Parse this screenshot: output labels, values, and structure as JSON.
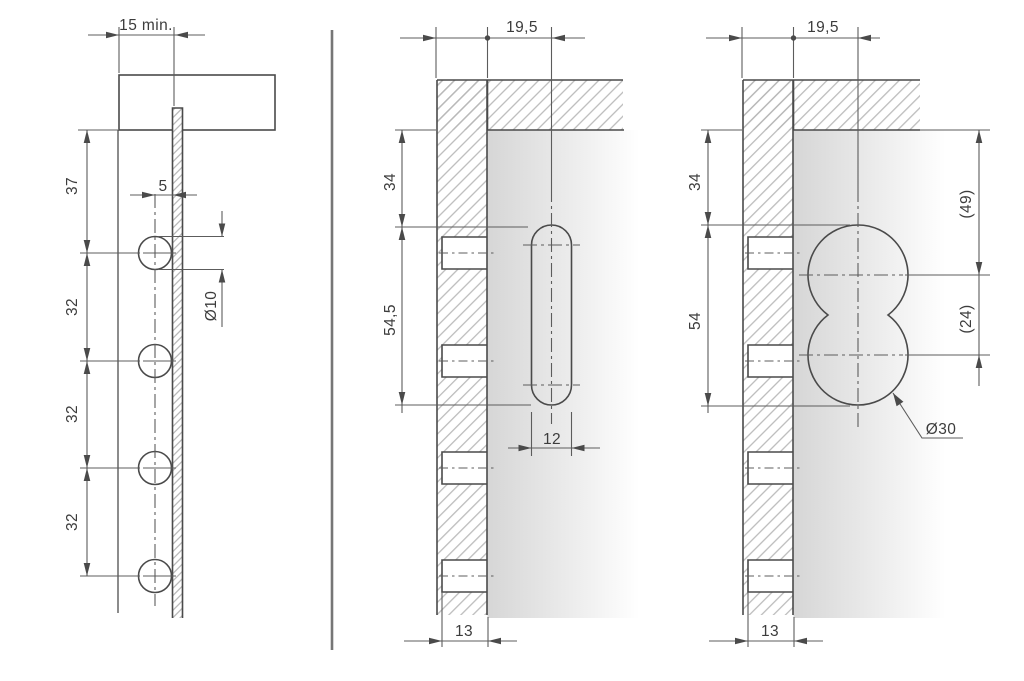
{
  "drawing": {
    "type": "furniture hinge mounting plate drilling diagram, three sectional views",
    "views": {
      "left": {
        "label": "side view - mounting plate on panel edge",
        "dims": {
          "edge_distance_min": "15 min.",
          "top_to_first_hole": "37",
          "hole_pitch": "32",
          "axis_to_front": "5",
          "hole_diameter": "Ø10"
        }
      },
      "middle": {
        "label": "front view - oblong slot cutout",
        "dims": {
          "front_to_axis": "19,5",
          "top_to_slot": "34",
          "slot_length": "54,5",
          "slot_width": "12",
          "drill_depth": "13"
        }
      },
      "right": {
        "label": "front view - double circle cutout",
        "dims": {
          "front_to_axis": "19,5",
          "top_to_cutout": "34",
          "cutout_height": "54",
          "ref_top_to_center": "(49)",
          "ref_center_distance": "(24)",
          "cutout_diameter": "Ø30",
          "drill_depth": "13"
        }
      }
    },
    "colors": {
      "background": "#ffffff",
      "object_line": "#4a4a4a",
      "thin_line": "#5c5c5c",
      "hatch": "#b7b7b7",
      "panel_shade": "#d6d6d6",
      "divider": "#767676",
      "text": "#3c3c3c"
    }
  }
}
